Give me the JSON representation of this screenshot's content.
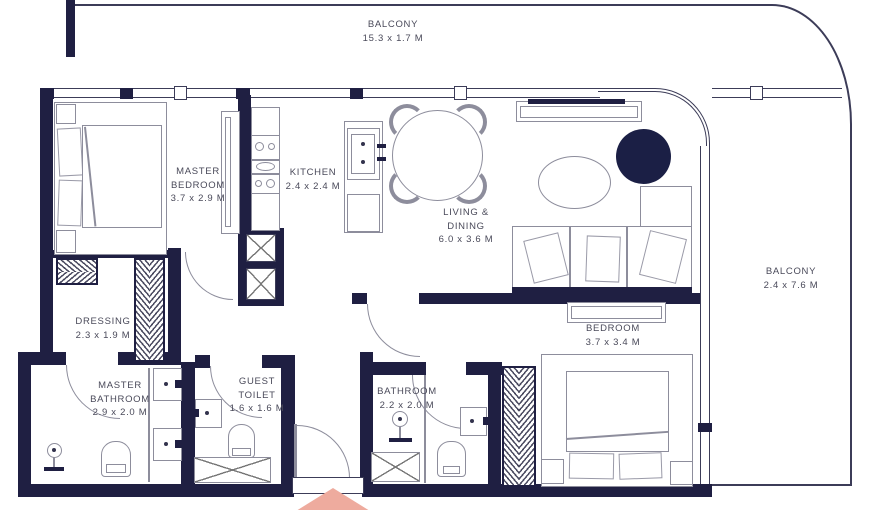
{
  "plan": {
    "unit_type": "floor-plan",
    "colors": {
      "wall": "#1f1f42",
      "furniture_line": "#8d8d9c",
      "accent_round_table": "#1b1f45",
      "entrance_marker": "#eeab9e"
    },
    "rooms": [
      {
        "id": "balcony-top",
        "line1": "BALCONY",
        "dims": "15.3 x 1.7 M"
      },
      {
        "id": "master-bedroom",
        "line1": "MASTER",
        "line2": "BEDROOM",
        "dims": "3.7 x 2.9 M"
      },
      {
        "id": "kitchen",
        "line1": "KITCHEN",
        "dims": "2.4 x 2.4 M"
      },
      {
        "id": "living-dining",
        "line1": "LIVING &",
        "line2": "DINING",
        "dims": "6.0 x 3.6 M"
      },
      {
        "id": "balcony-right",
        "line1": "BALCONY",
        "dims": "2.4 x 7.6 M"
      },
      {
        "id": "dressing",
        "line1": "DRESSING",
        "dims": "2.3 x 1.9 M"
      },
      {
        "id": "master-bathroom",
        "line1": "MASTER",
        "line2": "BATHROOM",
        "dims": "2.9 x 2.0 M"
      },
      {
        "id": "guest-toilet",
        "line1": "GUEST",
        "line2": "TOILET",
        "dims": "1.6 x 1.6 M"
      },
      {
        "id": "bathroom",
        "line1": "BATHROOM",
        "dims": "2.2 x 2.0 M"
      },
      {
        "id": "bedroom",
        "line1": "BEDROOM",
        "dims": "3.7 x 3.4 M"
      }
    ]
  }
}
